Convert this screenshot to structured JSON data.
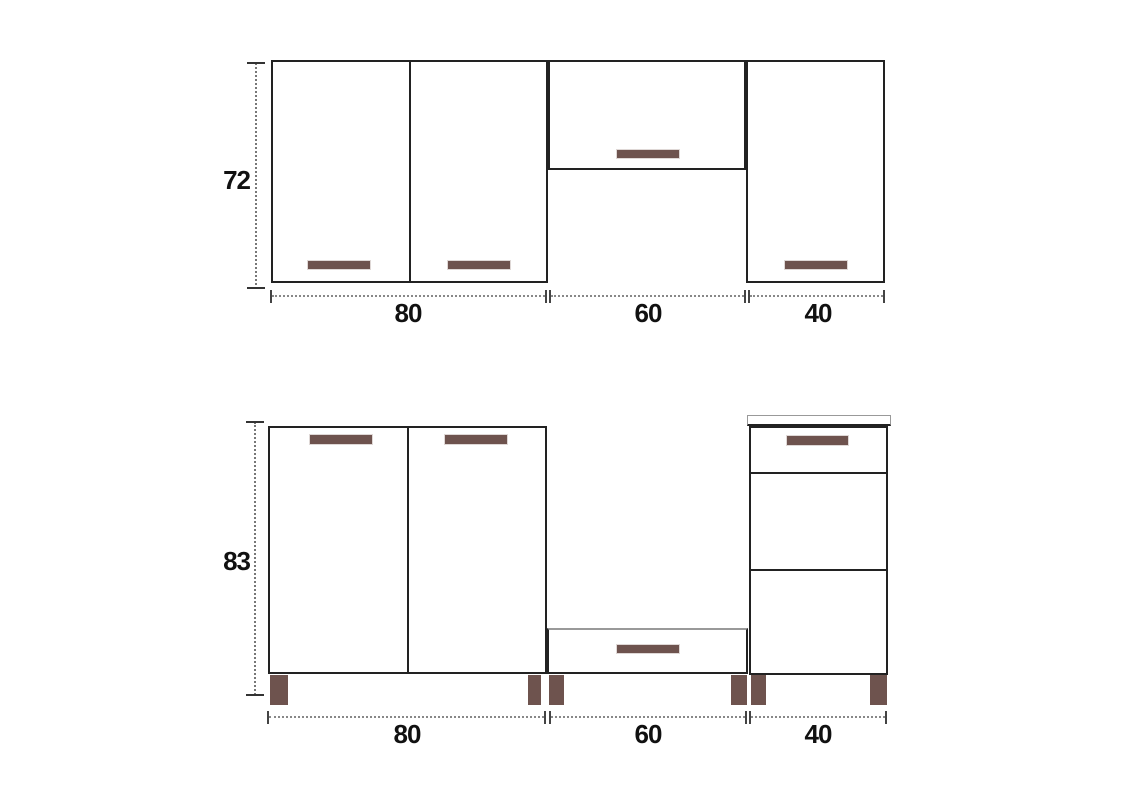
{
  "upper_row": {
    "height_label": "72",
    "width_labels": [
      "80",
      "60",
      "40"
    ]
  },
  "lower_row": {
    "height_label": "83",
    "width_labels": [
      "80",
      "60",
      "40"
    ]
  },
  "colors": {
    "handle": "#6e534e",
    "leg": "#6e534e",
    "outline": "#222222",
    "dimension": "#777777"
  }
}
